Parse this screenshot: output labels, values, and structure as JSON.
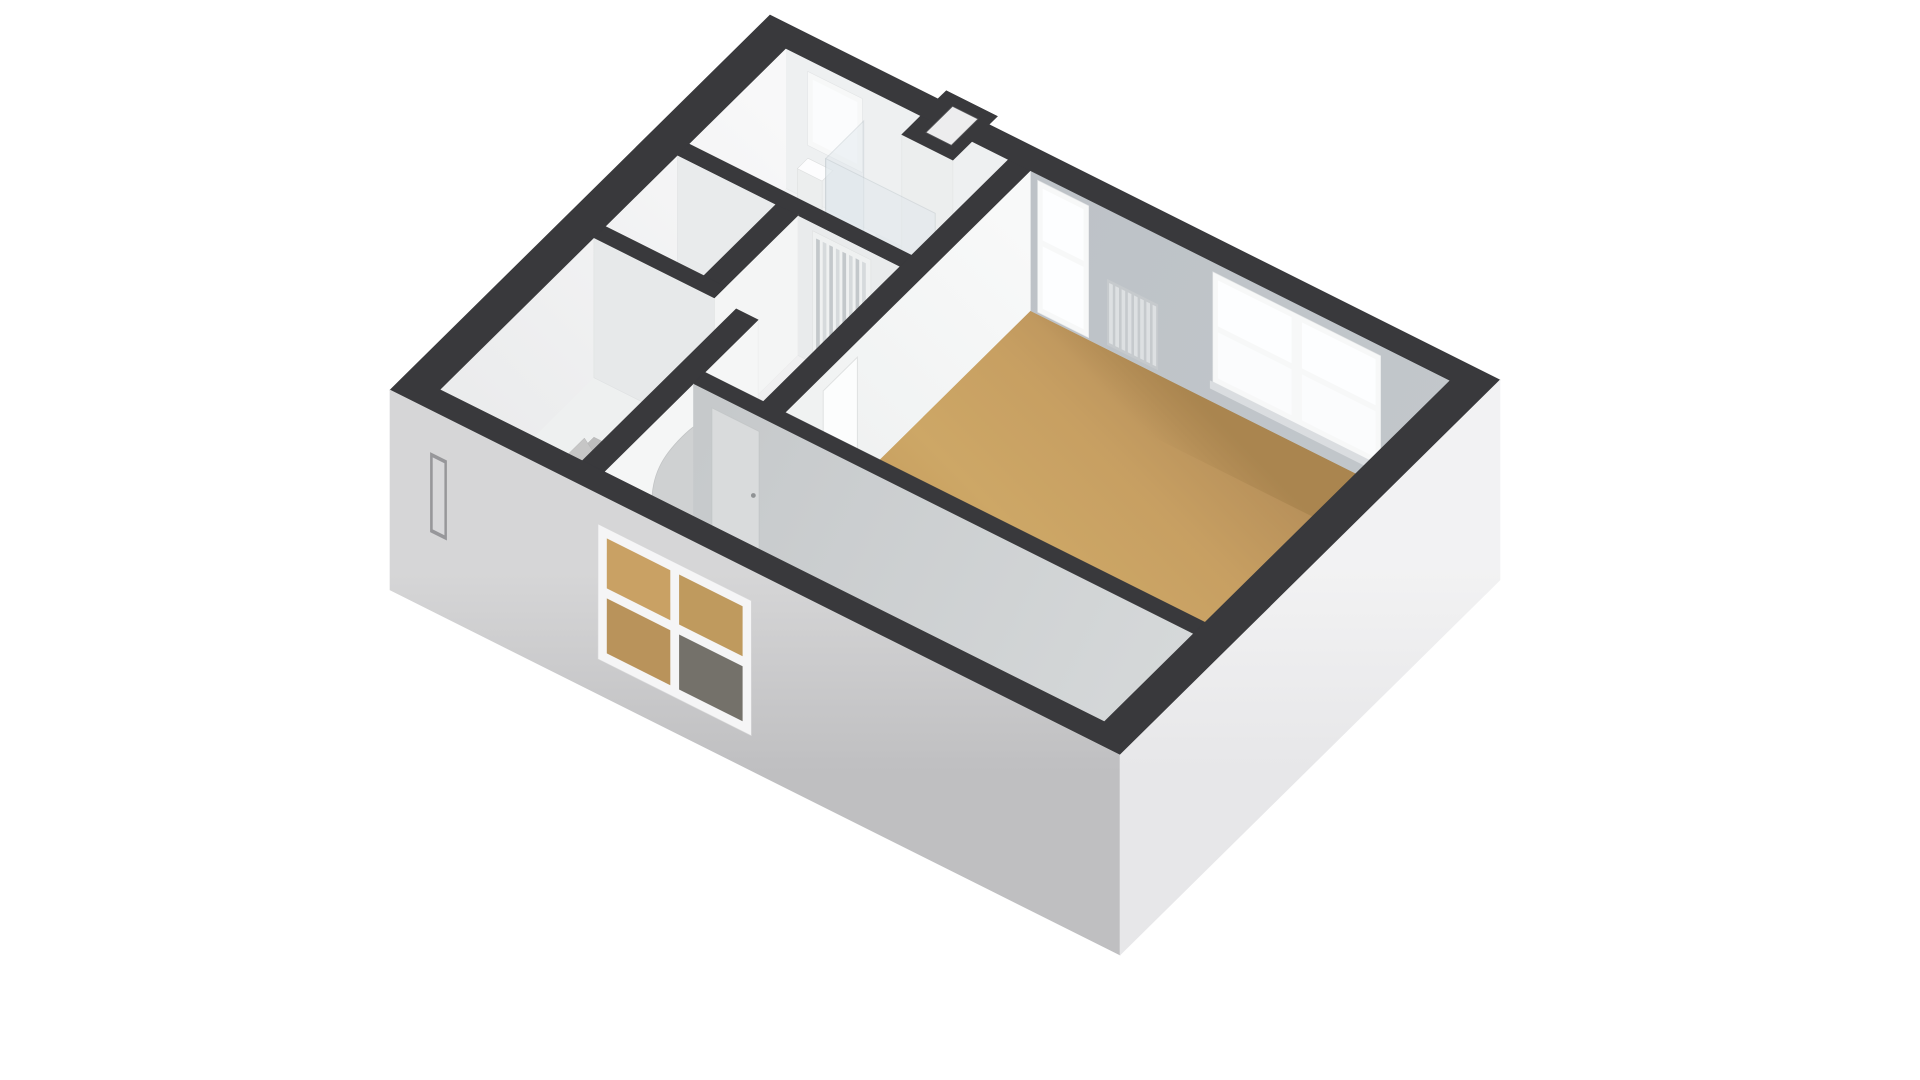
{
  "scene": {
    "type": "3d-floorplan-isometric",
    "label": "3d-floorplan",
    "background": "#ffffff"
  },
  "palette": {
    "background": "#ffffff",
    "wall_cap": "#39393c",
    "wall_lit": "#f7f7f8",
    "wall_light": "#eceeef",
    "wall_mid": "#e7e9ea",
    "wall_shaded": "#c2c7cb",
    "wall_shaded_dark": "#b3b8bd",
    "wall_shadow": "#9b9b9d",
    "floor_wood": "#c9a164",
    "floor_wood_dark": "#b08a52",
    "floor_wood_deep": "#a5814b",
    "floor_light": "#f0f1f1",
    "exterior_sw_top": "#d6d6d7",
    "exterior_sw_bottom": "#bfbfc1",
    "exterior_se_top": "#f2f2f3",
    "exterior_se_bottom": "#e7e7e9",
    "window_frame": "#f7f8f8",
    "window_pane": "#fdfeff",
    "window_sill": "#dadde0",
    "glass_shower": "#dfe7ec",
    "glass_edge": "#bdc6cb",
    "door_louver_a": "#d6dadc",
    "door_louver_b": "#c3c8cb",
    "door_leaf_light": "#fcfdfd",
    "door_leaf_shaded": "#d9dbdc",
    "handle": "#8f9294",
    "stair_deep": "#ababab",
    "stair_top": "#f7f7f7",
    "arch_void": "#cfd1d2",
    "radiator_a": "#dde0e2",
    "radiator_b": "#c6cacd",
    "shaft_void": "#ededee",
    "pane_wood_ul": "#c9a164",
    "pane_wood_ur": "#bf9a5e",
    "pane_wood_ll": "#b9935b",
    "pane_shadow_lr": "#74716a",
    "slit_recess": "#97979a",
    "slit_inner": "#d8d8da"
  },
  "rooms": [
    {
      "id": "bedroom-large",
      "floor": "wood"
    },
    {
      "id": "bedroom-small",
      "floor": "wood"
    },
    {
      "id": "bathroom",
      "floor": "light"
    },
    {
      "id": "closet",
      "floor": "light"
    },
    {
      "id": "hallway",
      "floor": "light"
    },
    {
      "id": "staircase-room",
      "floor": "light"
    }
  ],
  "windows": [
    {
      "id": "bathroom-window",
      "wall": "ne"
    },
    {
      "id": "bedroom-tall-window",
      "wall": "ne"
    },
    {
      "id": "bedroom-double-window",
      "wall": "ne"
    },
    {
      "id": "small-bedroom-window",
      "wall": "sw-exterior"
    },
    {
      "id": "stair-slit-window",
      "wall": "sw-exterior"
    }
  ],
  "doors": [
    {
      "id": "louvered-door",
      "room": "bathroom"
    },
    {
      "id": "bedroom-door-leaf",
      "room": "bedroom-large"
    },
    {
      "id": "small-bedroom-door-leaf",
      "room": "bedroom-small"
    }
  ],
  "features": [
    {
      "id": "winding-staircase",
      "treads": 10
    },
    {
      "id": "arched-doorway"
    },
    {
      "id": "shower-enclosure"
    },
    {
      "id": "toilet"
    },
    {
      "id": "radiator"
    },
    {
      "id": "chimney-shaft"
    }
  ]
}
